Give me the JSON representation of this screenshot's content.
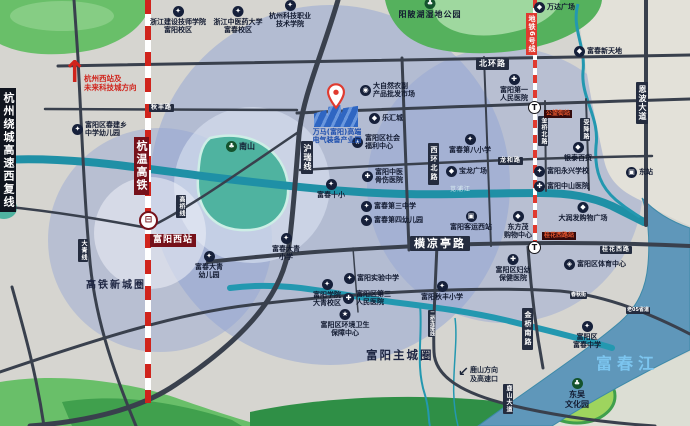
{
  "zones": {
    "hsr_new_town": "高铁新城圈",
    "main_city": "富阳主城圈"
  },
  "waters": {
    "fuchun_river": "富春江",
    "canal": "苋浦江"
  },
  "parks": {
    "yangpohu": "阳陂湖湿地公园",
    "nanshan": "南山",
    "dongwu": "东吴\n文化园"
  },
  "note": {
    "direction_text": "杭州西站及\n未来科技城方向",
    "lushan_text": "鹿山方向\n及高速口"
  },
  "railways": {
    "hangwen_hsr": "杭温高铁",
    "fuyang_west_station": "富阳西站",
    "metro_line6": "地铁6号线",
    "gongwang_station": "公望街站",
    "guihuaxilu_station": "桂花西路站"
  },
  "roads": {
    "ring_expressway": "杭州绕城高速西复线",
    "north_ring": "北环路",
    "enbo_avenue": "恩波大道",
    "hurui_line": "沪瑞线",
    "west_ring_north": "西环北路",
    "hengliangting": "横凉亭路",
    "jinqiao_south": "金桥南路",
    "jinqiao_north": "金桥北路",
    "lushan_avenue": "鹿山大道",
    "guihua_west": "桂花西路",
    "shoujiang": "受降路",
    "longhe": "龙和路",
    "gaoqiao_line": "高桥线",
    "daqing_line": "大青线",
    "qiufeng": "秋丰路",
    "chunqiu": "春秋街",
    "old_s05": "老05省道",
    "erqiao_link": "二桥连接线"
  },
  "industrial_park": {
    "name": "万马(富阳)高端\n电气装备产业园"
  },
  "pois": {
    "construction_college": {
      "t": "浙江建设技师学院\n富阳校区"
    },
    "tcm_university": {
      "t": "浙江中医药大学\n富春校区"
    },
    "hz_tech_college": {
      "t": "杭州科技职业\n技术学院"
    },
    "nature_market": {
      "t": "大自然农副\n产品批发市场"
    },
    "lehui_city": {
      "t": "乐汇城"
    },
    "welfare_center": {
      "t": "富阳区社会\n福利中心"
    },
    "no8_primary": {
      "t": "富春第八小学"
    },
    "first_hospital": {
      "t": "富阳第一\n人民医院"
    },
    "wanda_plaza": {
      "t": "万达广场"
    },
    "fuchun_new_world": {
      "t": "富春新天地"
    },
    "powerlong_plaza": {
      "t": "宝龙广场"
    },
    "intime_store": {
      "t": "银泰百货"
    },
    "yongxing_school": {
      "t": "富阳永兴学校"
    },
    "zhongshan_hospital": {
      "t": "富阳中山医院"
    },
    "rtmart": {
      "t": "大润发购物广场"
    },
    "bus_west_station": {
      "t": "富阳客运西站"
    },
    "dongfangmao": {
      "t": "东方茂\n购物中心"
    },
    "no10_primary": {
      "t": "富春十小"
    },
    "tcm_bone_hospital": {
      "t": "富阳中医\n骨伤医院"
    },
    "no3_middle": {
      "t": "富春第三中学"
    },
    "no4_kindergarten": {
      "t": "富春第四幼儿园"
    },
    "daqing_primary": {
      "t": "富春大青\n小学"
    },
    "daqing_kindergarten": {
      "t": "富春大青\n幼儿园"
    },
    "chunjian_kindergarten": {
      "t": "富阳区春建乡\n中学幼儿园"
    },
    "fuyang_college_daqing": {
      "t": "富阳学院\n大青校区"
    },
    "experimental_middle": {
      "t": "富阳实验中学"
    },
    "no3_people_hospital": {
      "t": "富阳区第三\n人民医院"
    },
    "qiufeng_primary": {
      "t": "富阳秋丰小学"
    },
    "sanitation_center": {
      "t": "富阳区环境卫生\n保障中心"
    },
    "maternity_hospital": {
      "t": "富阳区妇幼\n保健医院"
    },
    "sports_center": {
      "t": "富阳区体育中心"
    },
    "fuchun_middle": {
      "t": "富阳区\n富春中学"
    },
    "bus_east_station": {
      "t": "东站"
    }
  },
  "icons": {
    "school": "✦",
    "hospital": "✚",
    "mall": "◆",
    "market": "◉",
    "government": "★",
    "bus": "▣",
    "sport": "◈",
    "park": "♣",
    "train": "⊟",
    "metro": "T"
  },
  "colors": {
    "coverage_blue": "#8fa3d4",
    "road_dark": "#39404d",
    "river_teal": "#2398b0",
    "river_main": "#5f97ba",
    "rail_red": "#d0241c",
    "metro_red": "#e03a2f",
    "station_maroon": "#76111a",
    "park_green": "#57b25e",
    "pin_red": "#e03a2f",
    "factory_blue": "#2f66c2"
  }
}
